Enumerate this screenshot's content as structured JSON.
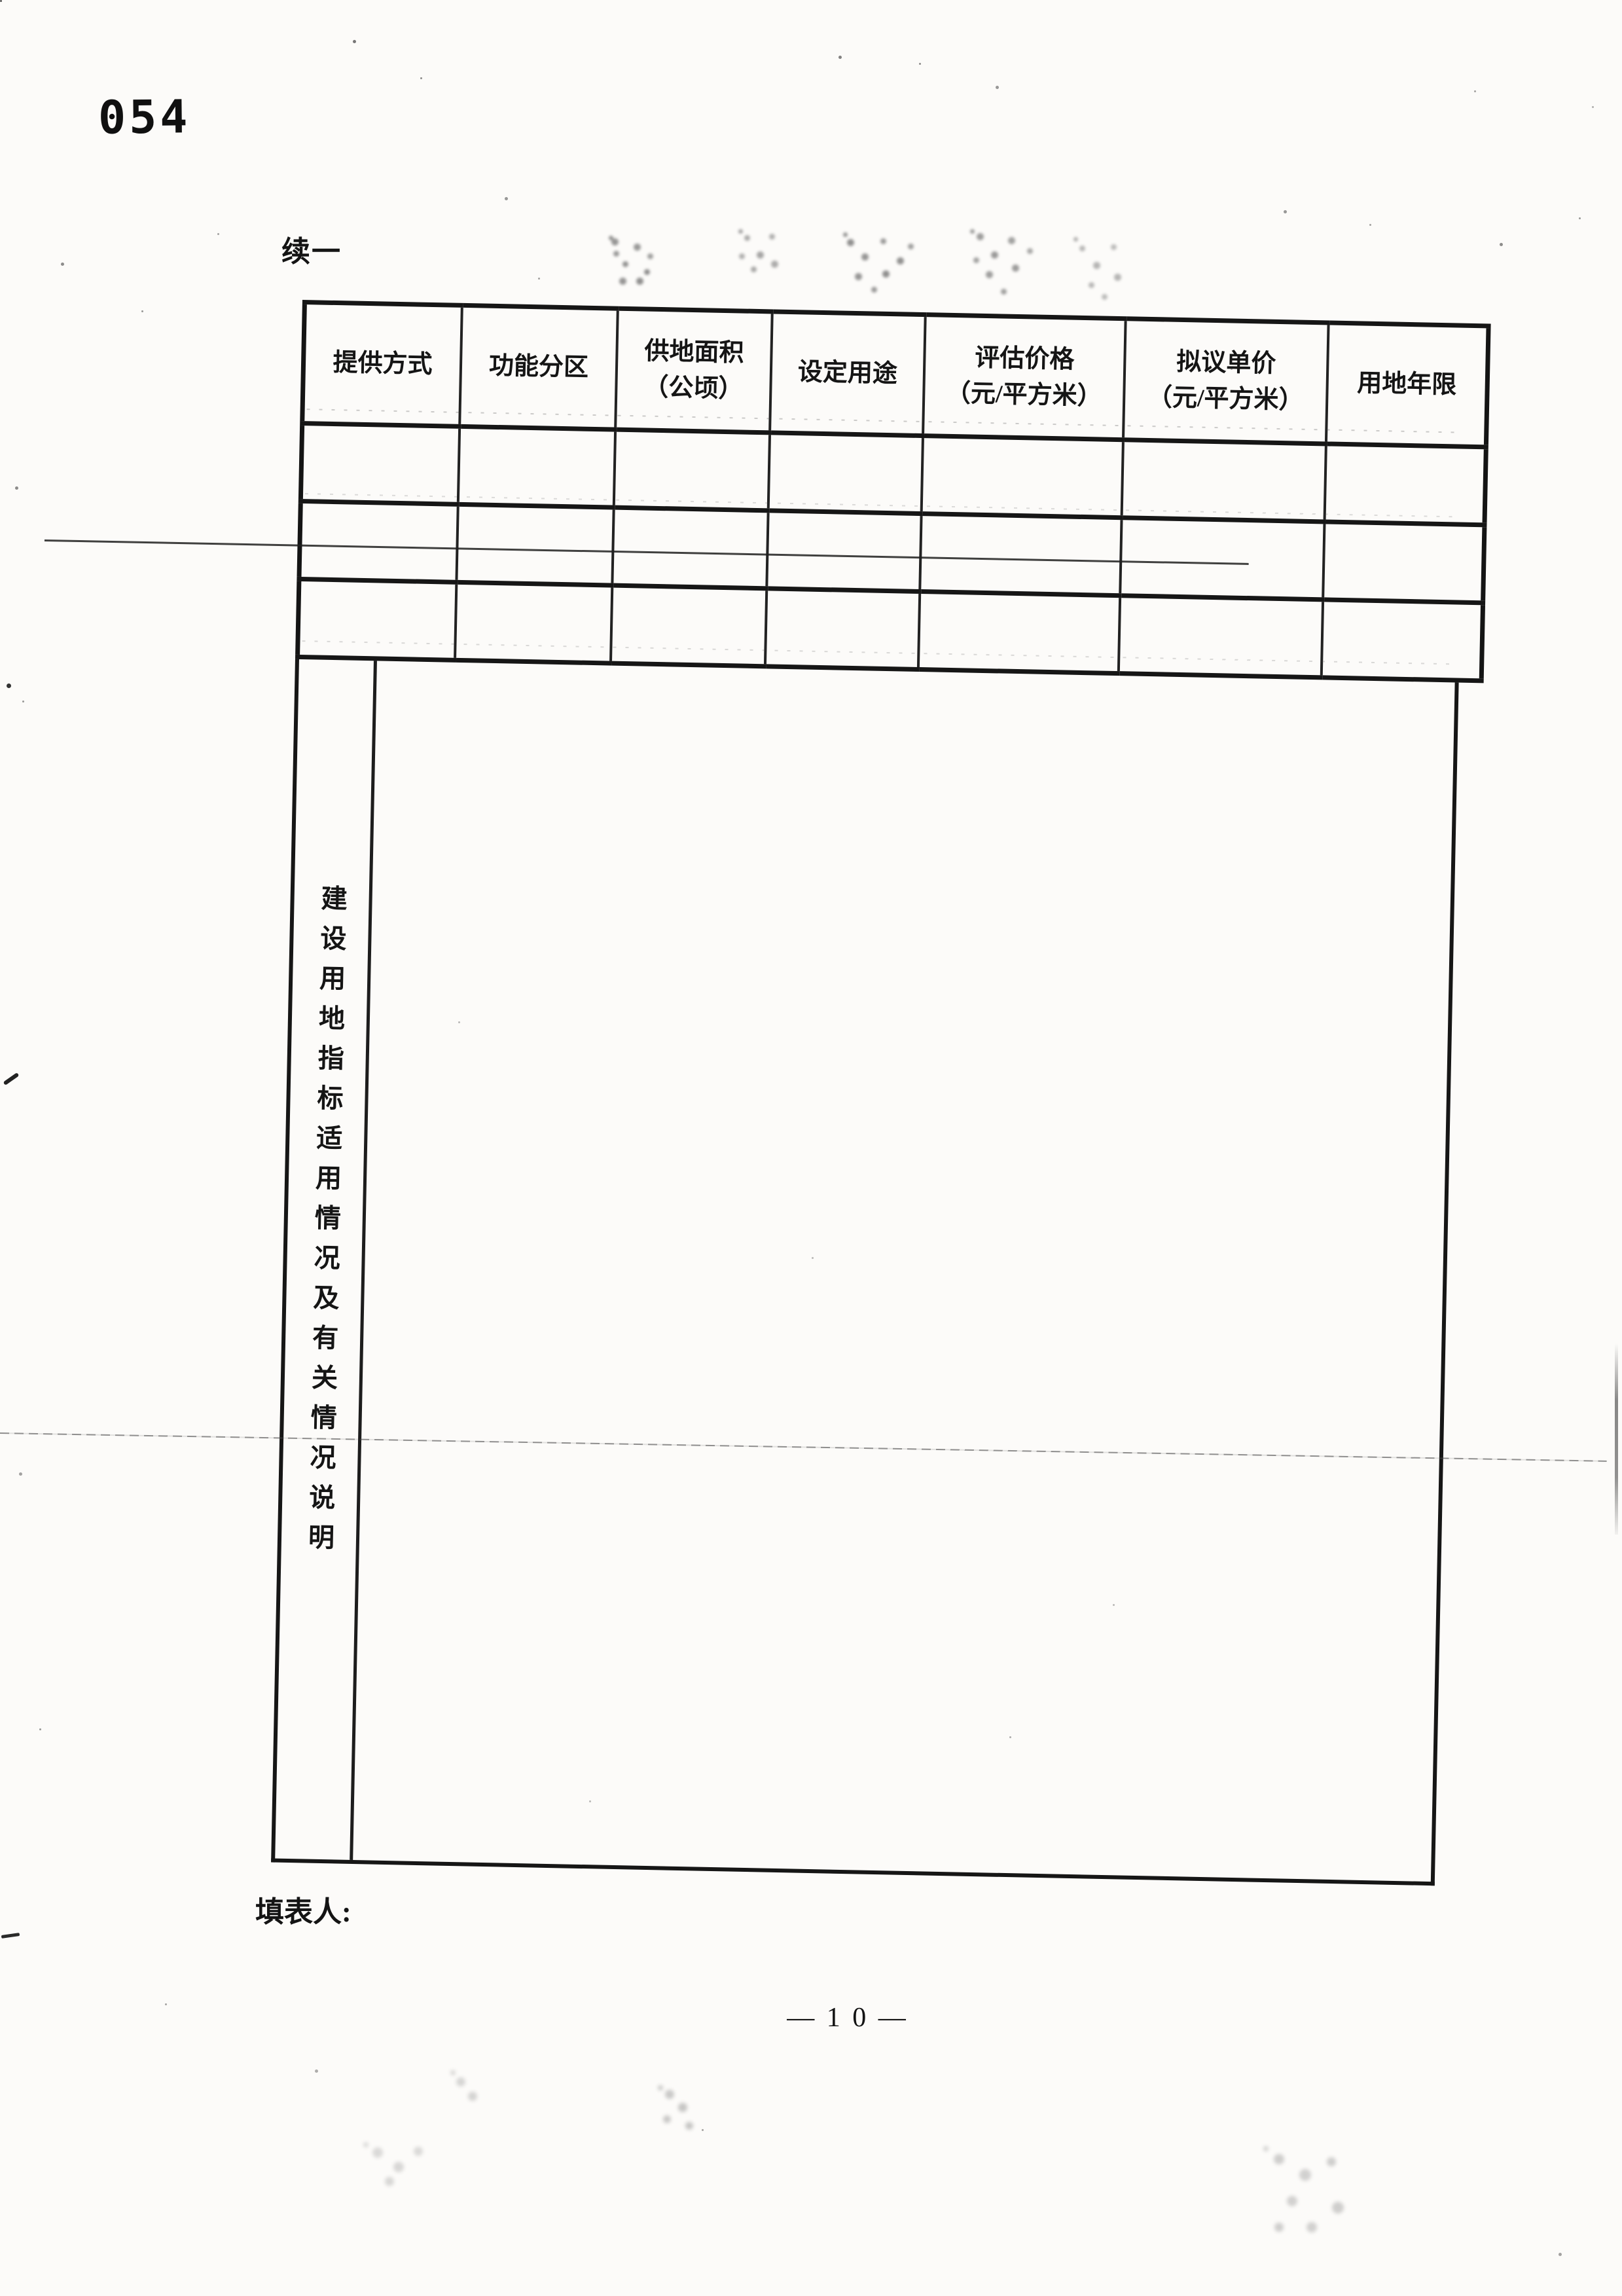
{
  "page": {
    "stamp_number": "054",
    "continuation_label": "续一",
    "form_filler_label": "填表人:",
    "page_number": "— 1 0 —"
  },
  "table": {
    "headers": [
      "提供方式",
      "功能分区",
      "供地面积\n（公顷）",
      "设定用途",
      "评估价格\n（元/平方米）",
      "拟议单价\n（元/平方米）",
      "用地年限"
    ],
    "rows": [
      [
        "",
        "",
        "",
        "",
        "",
        "",
        ""
      ],
      [
        "",
        "",
        "",
        "",
        "",
        "",
        ""
      ],
      [
        "",
        "",
        "",
        "",
        "",
        "",
        ""
      ]
    ],
    "section_label": "建设用地指标适用情况及有关情况说明"
  },
  "colors": {
    "paper": "#fcfbf9",
    "ink": "#1a1a1a"
  }
}
